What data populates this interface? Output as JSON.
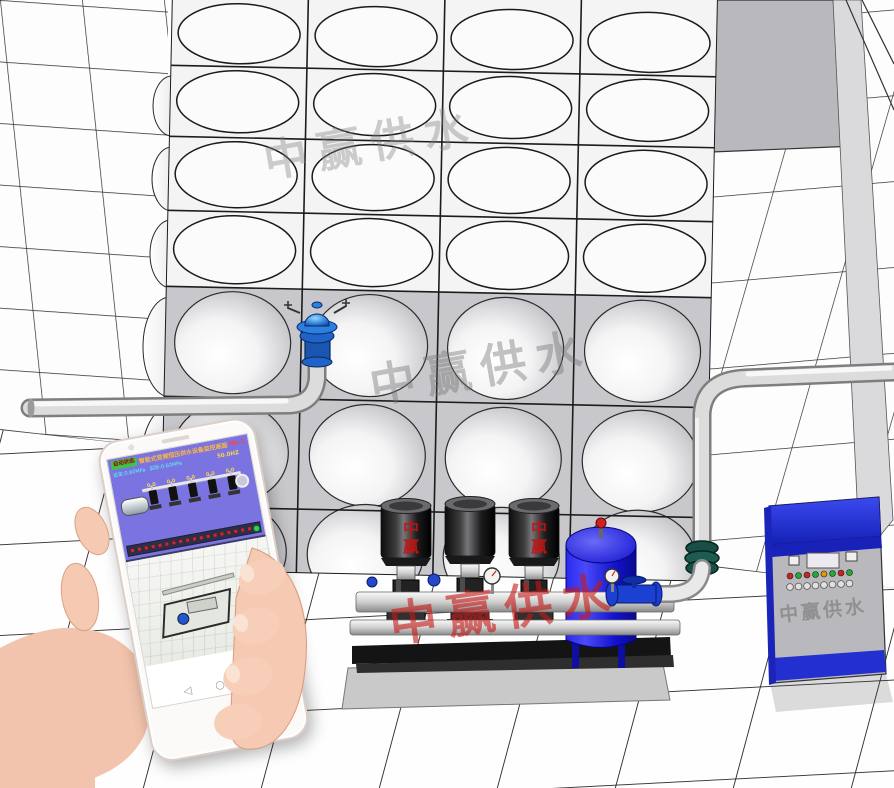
{
  "watermark": {
    "text": "中赢供水",
    "brand_vertical": "中赢",
    "color_gray": "#7d7d7d",
    "color_red": "#c61818"
  },
  "phone": {
    "hmi": {
      "status_badge": "自动状态",
      "title": "智能式变频恒压供水设备监控画面",
      "unit_label": "No.1",
      "set_pressure": "设定:0.60MPa",
      "actual_pressure": "实际:0.60MPa",
      "frequency": "50.0HZ",
      "pump_values": [
        "0.0",
        "0.0",
        "0.0",
        "0.0",
        "0.0"
      ],
      "colors": {
        "background": "#7b74e0",
        "badge_green": "#3ec24a",
        "value_yellow": "#ffd24a",
        "label_cyan": "#55ffee",
        "ticker_red": "#e02020",
        "run_led_green": "#22dd44"
      }
    },
    "nav_icons": [
      {
        "name": "back",
        "glyph": "◁"
      },
      {
        "name": "home",
        "glyph": "○"
      },
      {
        "name": "recents",
        "glyph": "□"
      }
    ]
  },
  "equipment": {
    "water_tank": {
      "visible_columns": 4,
      "visible_rows": 7
    },
    "pumps_visible": 3,
    "pressure_tank_color": "#1a1ad8",
    "control_cabinet": {
      "top_color": "#2433d6",
      "body_color": "#b9b9bd",
      "led_colors": [
        "#cc2222",
        "#22aa33",
        "#cc2222",
        "#22aa33",
        "#dd9900",
        "#22aa33",
        "#cc2222",
        "#22aa33"
      ]
    }
  }
}
